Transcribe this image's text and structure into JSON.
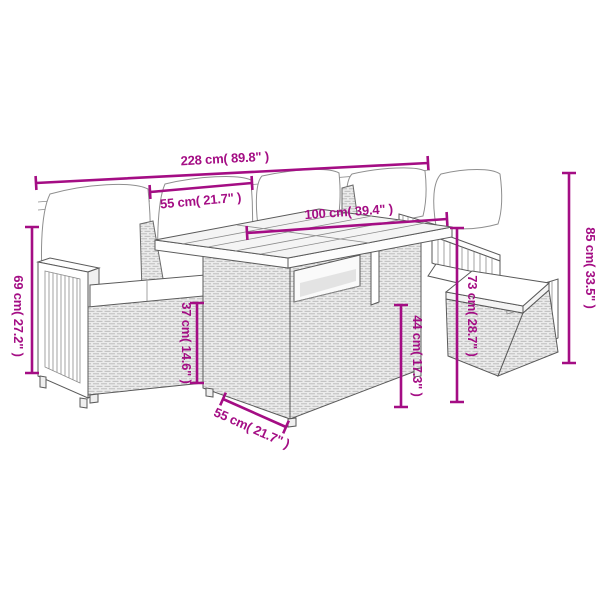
{
  "colors": {
    "dimension": "#a40d84",
    "outline": "#5a5a5a",
    "background": "#ffffff"
  },
  "dimensions": {
    "overall_width": {
      "label": "228 cm( 89.8\" )"
    },
    "seat_width": {
      "label": "55 cm( 21.7\" )"
    },
    "table_top_width": {
      "label": "100 cm( 39.4\" )"
    },
    "overall_height": {
      "label": "85 cm( 33.5\" )"
    },
    "table_height": {
      "label": "73 cm( 28.7\" )"
    },
    "armrest_height": {
      "label": "69 cm( 27.2\" )"
    },
    "seat_height": {
      "label": "37 cm( 14.6\" )"
    },
    "table_lower_height": {
      "label": "44 cm( 17.3\" )"
    },
    "table_depth": {
      "label": "55 cm( 21.7\" )"
    }
  }
}
